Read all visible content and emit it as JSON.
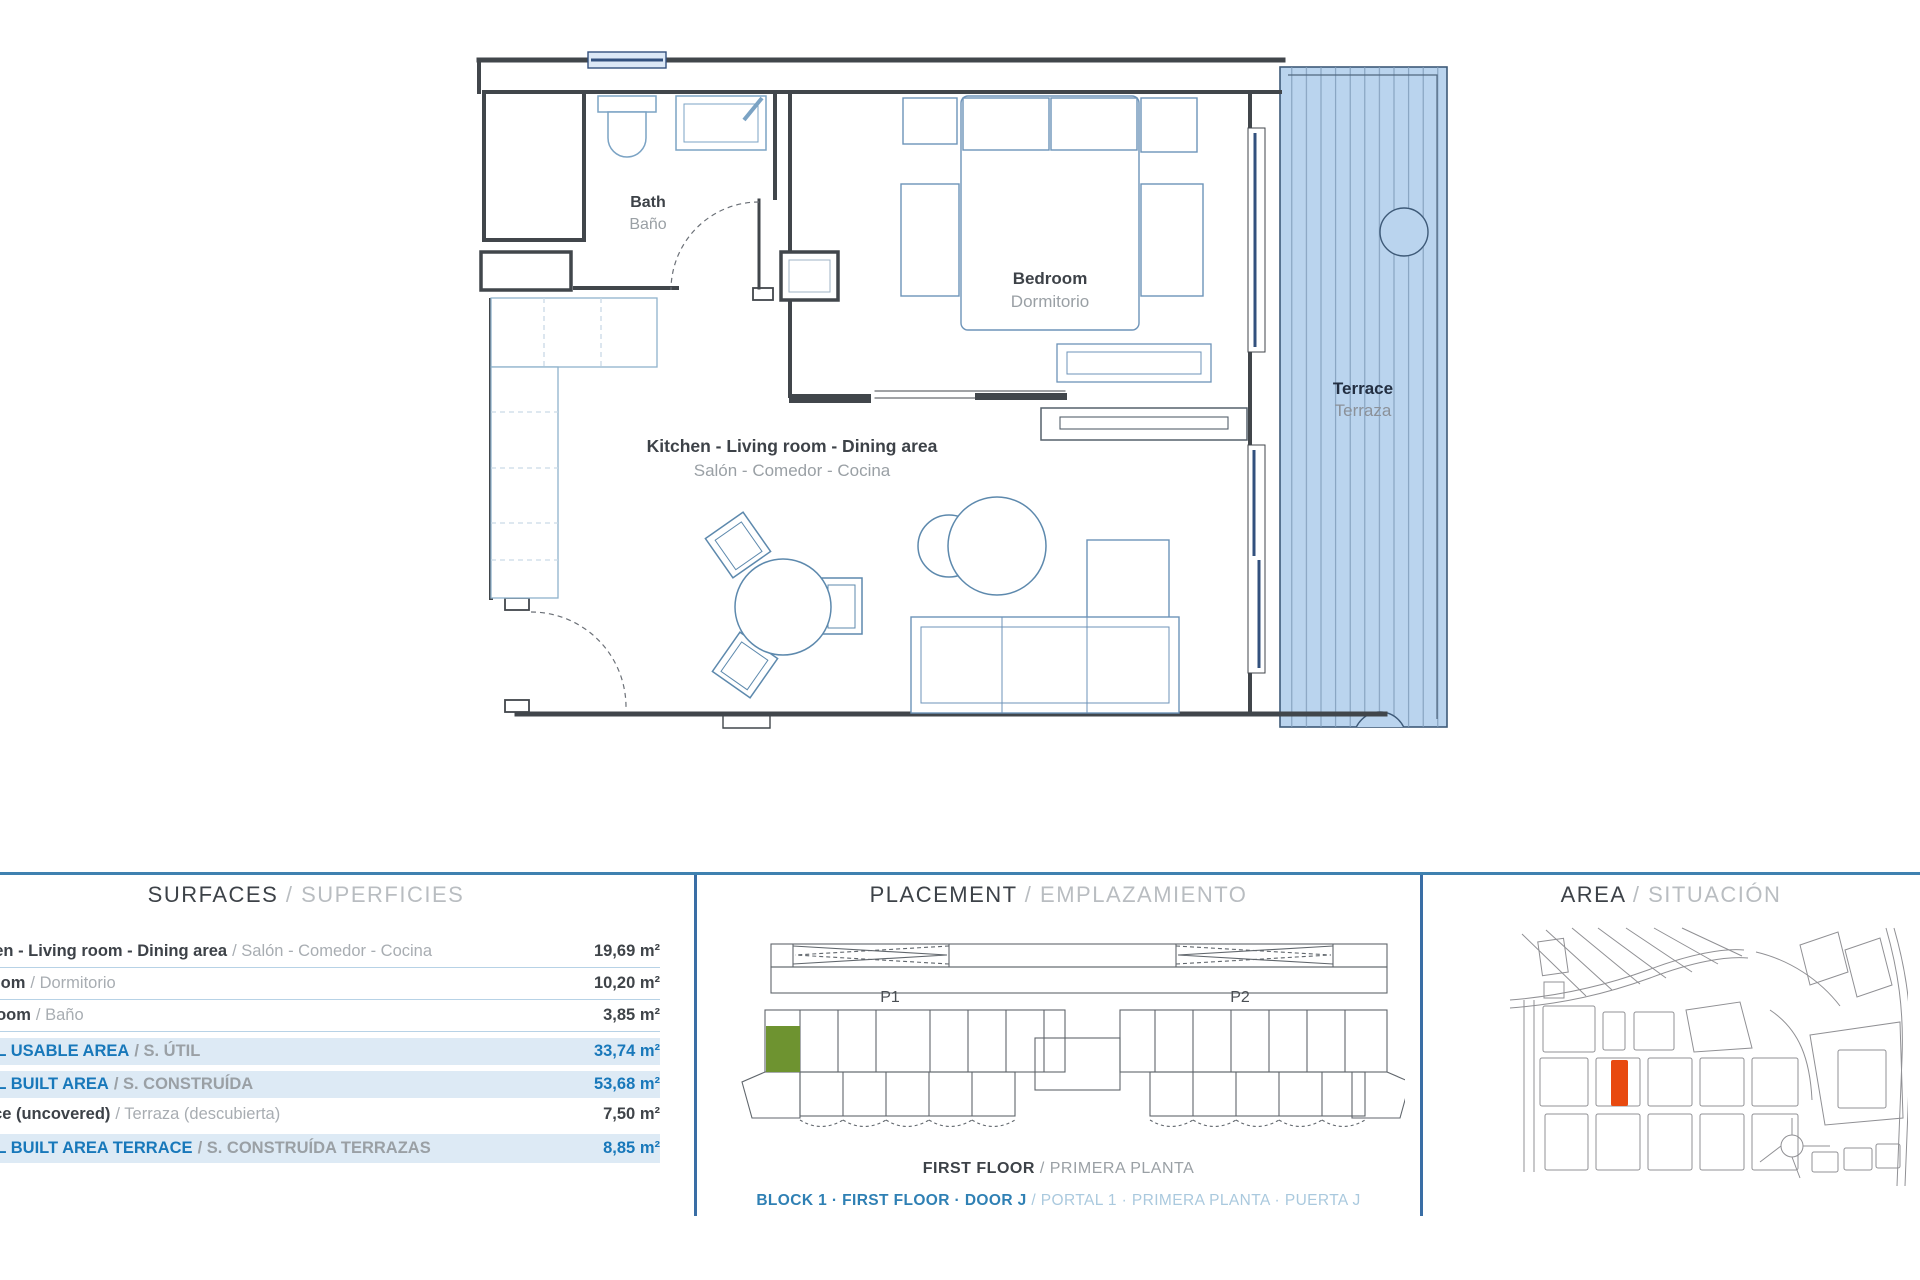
{
  "floor_plan": {
    "rooms": {
      "bath": {
        "en": "Bath",
        "es": "Baño"
      },
      "bedroom": {
        "en": "Bedroom",
        "es": "Dormitorio"
      },
      "living": {
        "en": "Kitchen - Living room - Dining area",
        "es": "Salón - Comedor - Cocina"
      },
      "terrace": {
        "en": "Terrace",
        "es": "Terraza"
      }
    }
  },
  "surfaces": {
    "title_en": "SURFACES",
    "title_es": "SUPERFICIES",
    "rows": [
      {
        "en": "Kitchen - Living room - Dining area",
        "es": "Salón - Comedor - Cocina",
        "value": "19,69 m²",
        "highlight": false
      },
      {
        "en": "Bedroom",
        "es": "Dormitorio",
        "value": "10,20 m²",
        "highlight": false
      },
      {
        "en": "Bathroom",
        "es": "Baño",
        "value": "3,85 m²",
        "highlight": false
      },
      {
        "en": "TOTAL USABLE AREA",
        "es": "S. ÚTIL",
        "value": "33,74 m²",
        "highlight": true
      },
      {
        "en": "TOTAL BUILT AREA",
        "es": "S. CONSTRUÍDA",
        "value": "53,68 m²",
        "highlight": true
      },
      {
        "en": "Terrace (uncovered)",
        "es": "Terraza (descubierta)",
        "value": "7,50 m²",
        "highlight": false
      },
      {
        "en": "TOTAL BUILT AREA TERRACE",
        "es": "S. CONSTRUÍDA TERRAZAS",
        "value": "8,85 m²",
        "highlight": true
      }
    ]
  },
  "placement": {
    "title_en": "PLACEMENT",
    "title_es": "EMPLAZAMIENTO",
    "block_labels": {
      "p1": "P1",
      "p2": "P2"
    },
    "floor_en": "FIRST FLOOR",
    "floor_es": "PRIMERA PLANTA",
    "unit_en": "BLOCK 1 · FIRST FLOOR · DOOR J",
    "unit_es": "PORTAL 1 · PRIMERA PLANTA · PUERTA J"
  },
  "area": {
    "title_en": "AREA",
    "title_es": "SITUACIÓN"
  },
  "colors": {
    "accent_border": "#3f81b0",
    "highlight_row_bg": "#ddeaf5",
    "highlight_text": "#1878ba",
    "terrace_fill": "#bad4ee",
    "placement_unit_green": "#6e9330",
    "map_plot_orange": "#e8490f",
    "wall": "#41464b"
  }
}
